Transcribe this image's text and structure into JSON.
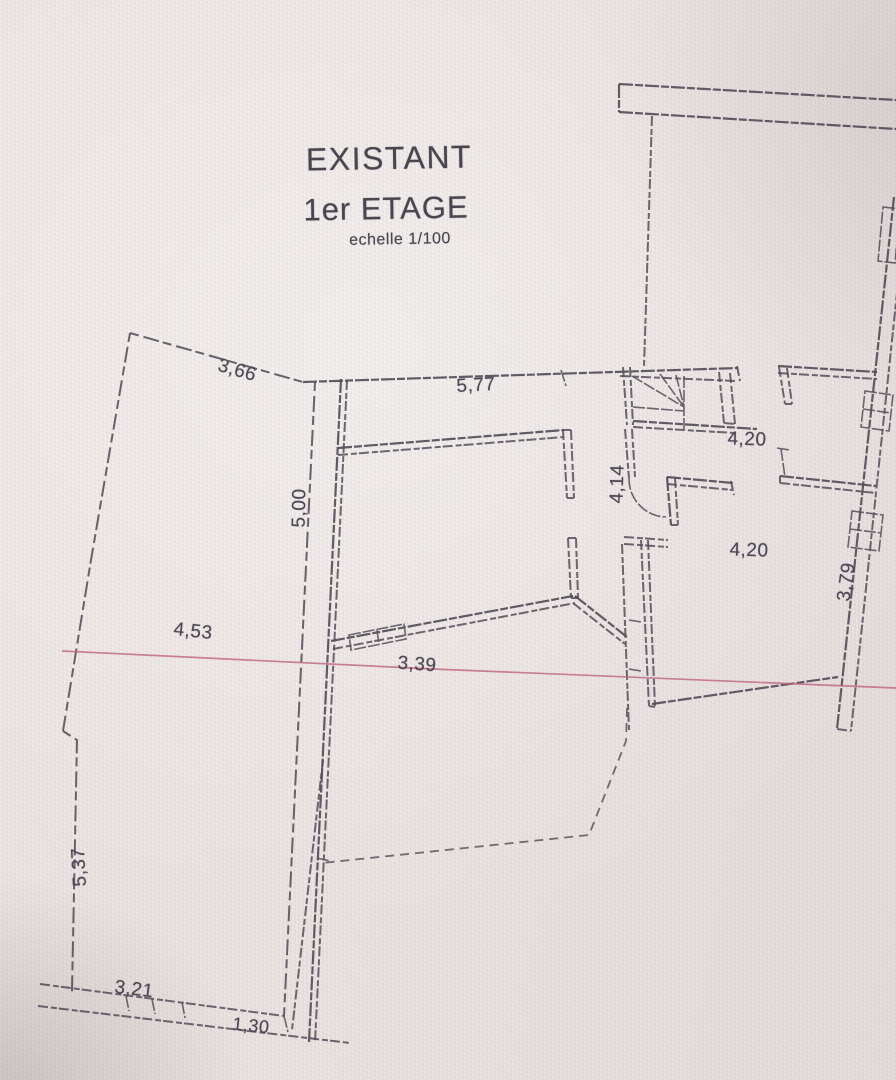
{
  "title": {
    "line1": "EXISTANT",
    "line2": "1er ETAGE",
    "scale": "echelle 1/100"
  },
  "dimensions": [
    {
      "label": "3,66"
    },
    {
      "label": "5,77"
    },
    {
      "label": "4,20"
    },
    {
      "label": "4,14"
    },
    {
      "label": "4,20"
    },
    {
      "label": "5,00"
    },
    {
      "label": "3,79"
    },
    {
      "label": "4,53"
    },
    {
      "label": "3,39"
    },
    {
      "label": "5,37"
    },
    {
      "label": "3,21"
    },
    {
      "label": "1,30"
    }
  ],
  "colors": {
    "paper": "#e9e1df",
    "ink": "#534e59",
    "marker_line": "#bf6480",
    "text": "#4c4754"
  }
}
